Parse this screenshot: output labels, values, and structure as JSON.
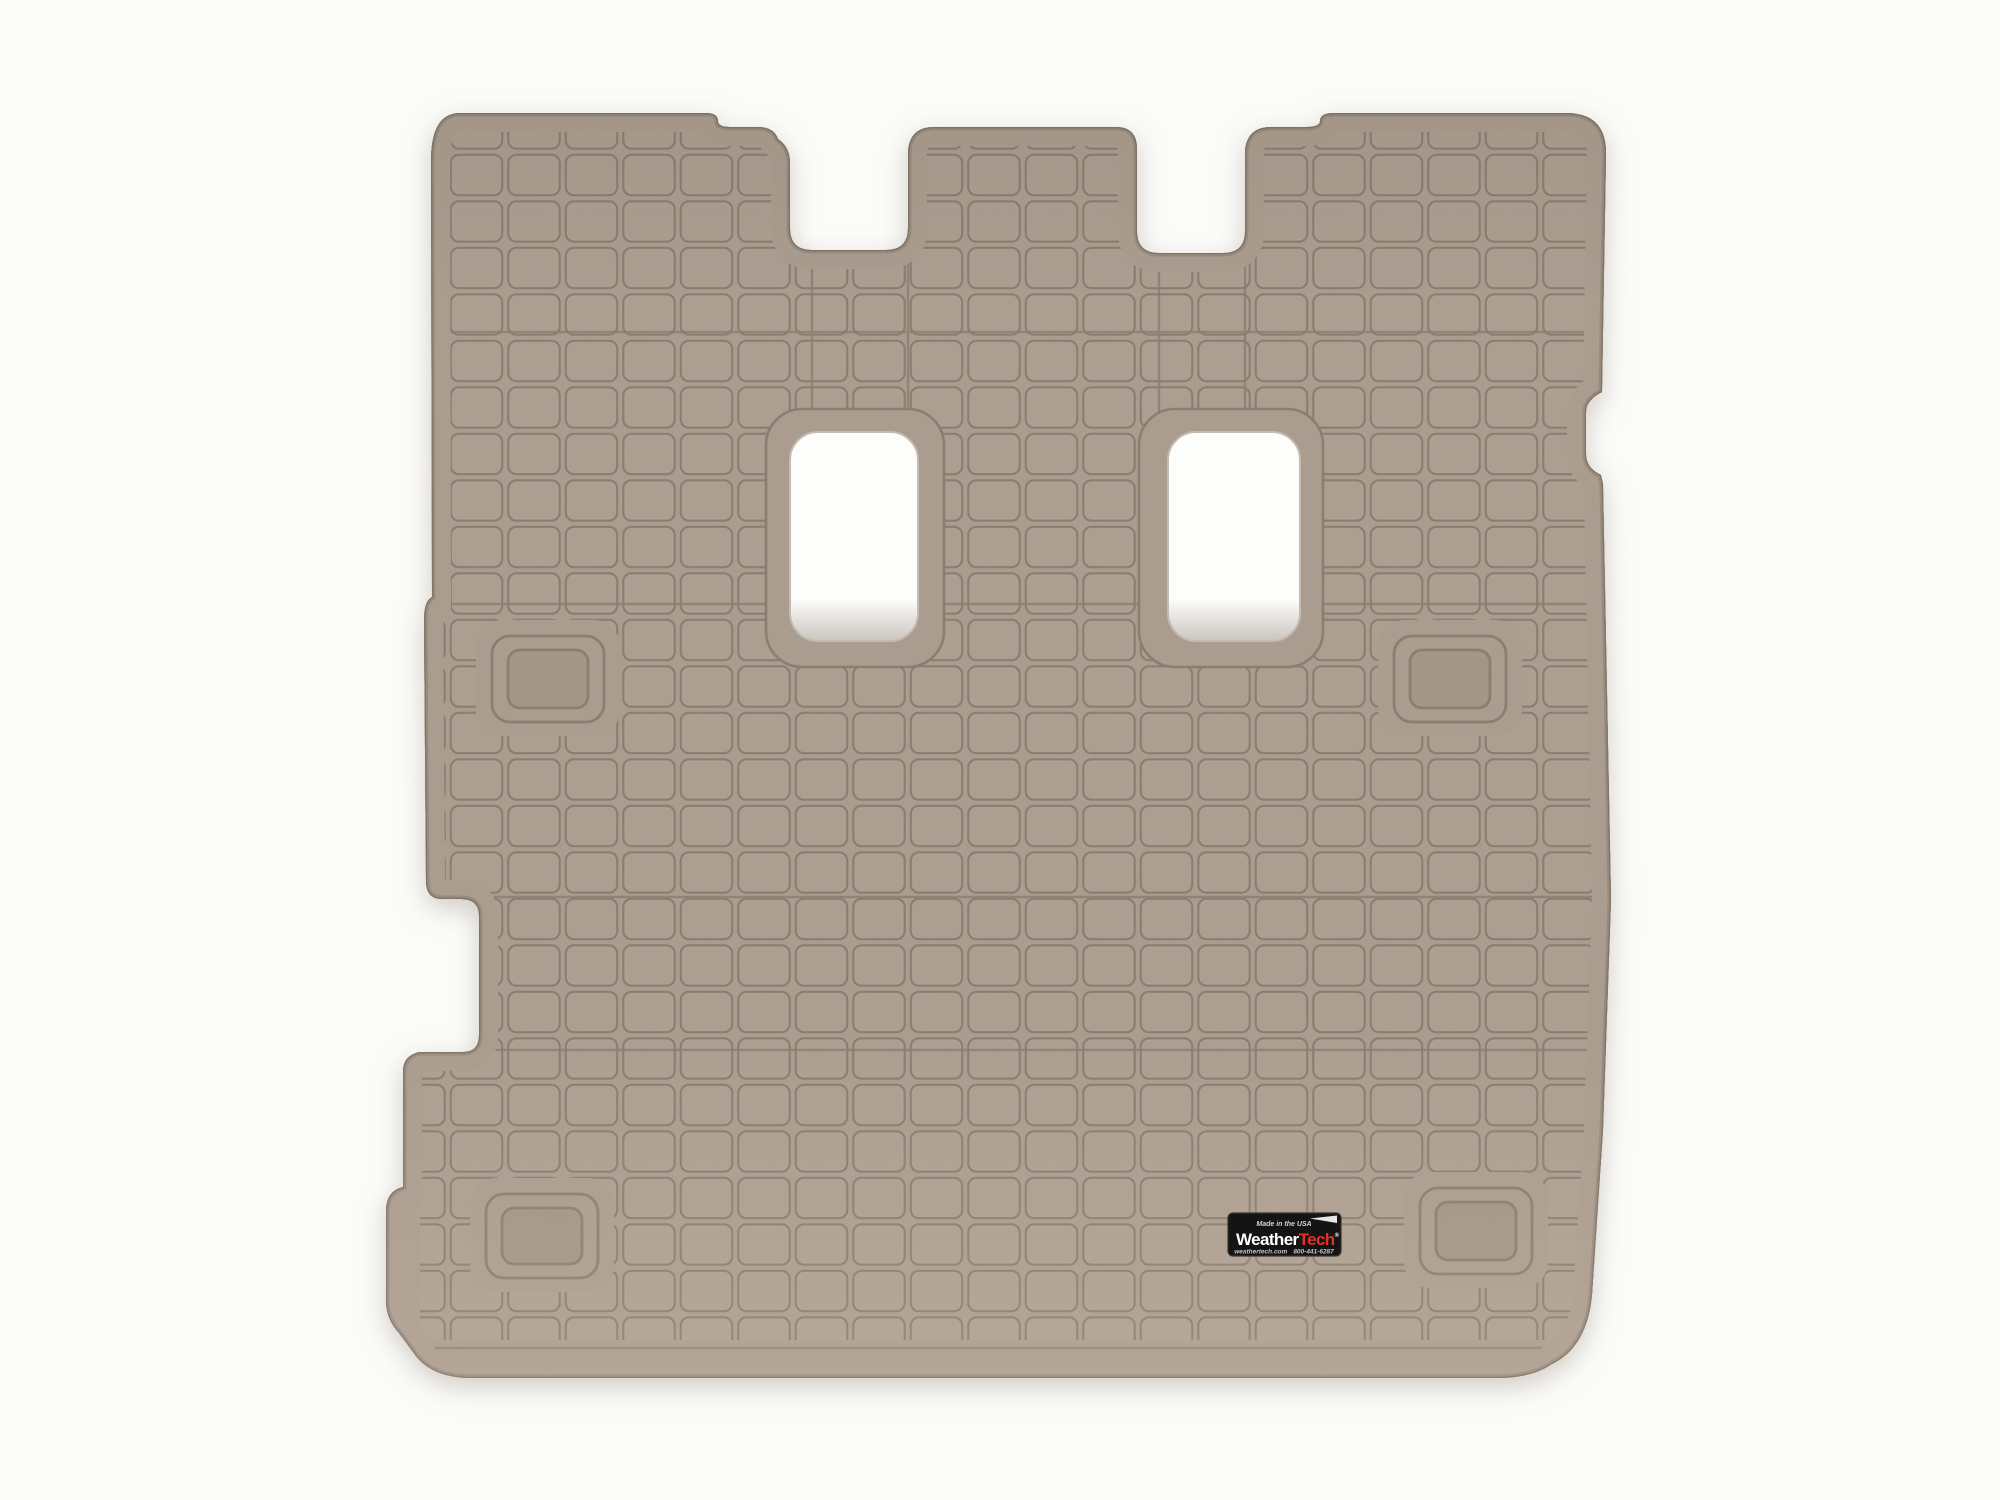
{
  "product": {
    "name": "WeatherTech cargo liner floor mat",
    "color_name": "Tan",
    "badge": {
      "made_in": "Made in the USA",
      "brand_weather": "Weather",
      "brand_tech": "Tech",
      "registered_mark": "®",
      "website": "weathertech.com",
      "phone": "800-441-6287"
    },
    "colors": {
      "mat_tan": "#aa9c8e",
      "cell_tan": "#ac9e90",
      "groove_brown": "#8a7c6f",
      "edge_shade": "#95887a",
      "hole_white": "#fdfdfc",
      "badge_black": "#141414",
      "brand_red": "#e23128",
      "background_white": "#fbfbf9"
    }
  }
}
